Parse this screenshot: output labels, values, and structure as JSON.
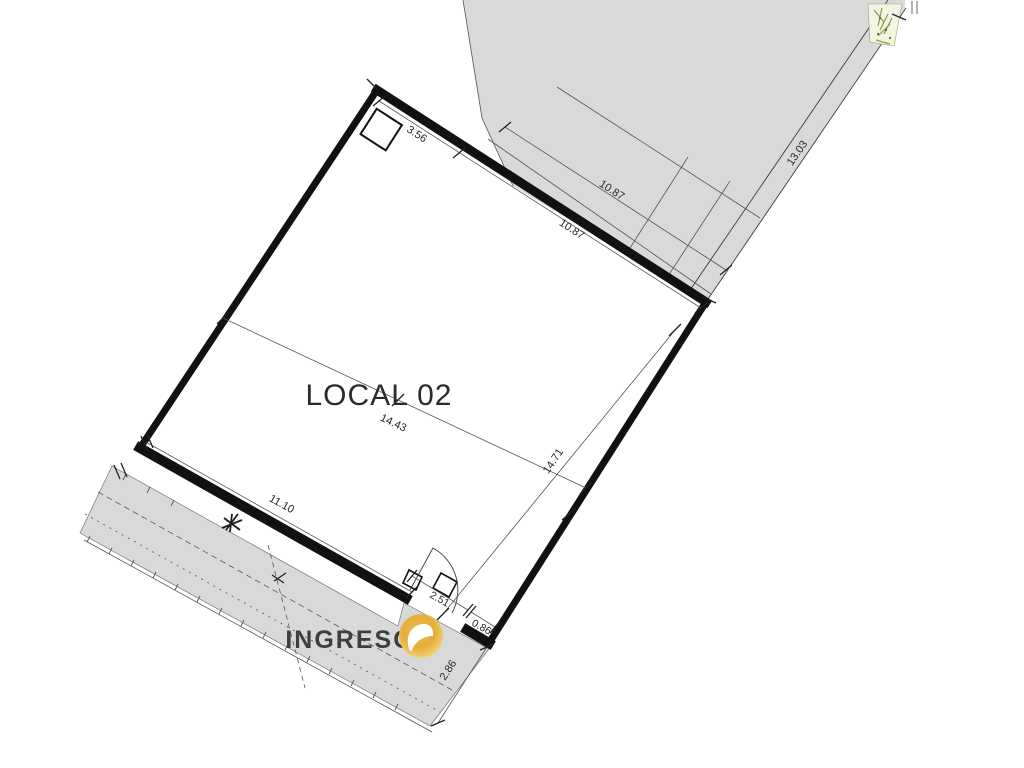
{
  "plan": {
    "room_label": "LOCAL 02",
    "entrance_label": "INGRESO"
  },
  "dimensions": {
    "top_left_inner": "3.56",
    "top_inner": "10.87",
    "top_outer": "10.87",
    "lot_line_right": "13.03",
    "diagonal": "14.43",
    "right_inner": "14.71",
    "bottom_inner": "11.10",
    "door_width": "2.51",
    "corner_pier": "0.86",
    "sidewalk_depth": "2.86"
  },
  "colors": {
    "area_fill": "#d9d9d9",
    "sidewalk_fill": "#d9d9d9",
    "planter_fill": "#f2f4e4",
    "planter_green": "#8a9b4a",
    "wall_line": "#111111",
    "text": "#262626",
    "entrance_text": "#3e3e3e",
    "logo_gold": "#e5ad3a",
    "logo_gold_light": "#f6dd90"
  },
  "icons": {
    "logo": "gold-circle-arrow-watermark",
    "shrub": "shrub-symbol",
    "planter": "garden-bed-hatch"
  }
}
